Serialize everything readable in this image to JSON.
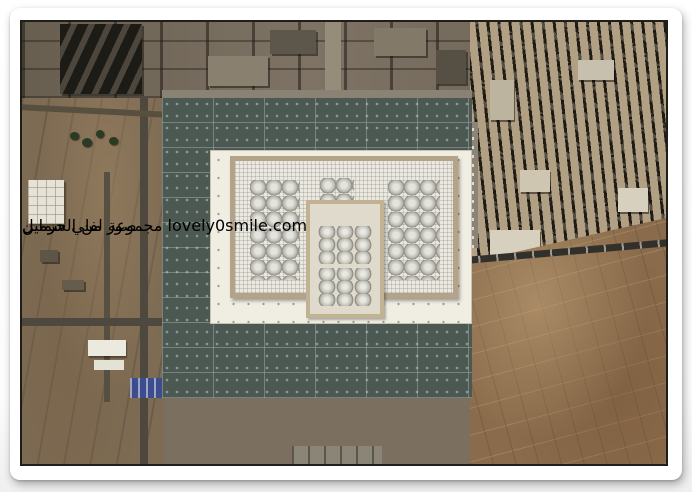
{
  "watermark": {
    "group_ar": "مجموعة لفلي سمايل",
    "domain": "lovely0smile.com"
  },
  "calligraphy": {
    "title_ar": "صور من الحرمين"
  },
  "icons": {
    "top_right": "green-corner-swoosh",
    "bottom_right": "green-swoosh-with-minaret",
    "center": "green-dome-of-mosque"
  },
  "colors": {
    "ribbon_green": "#57b42c",
    "ribbon_green_dark": "#2e8a12",
    "decor_green_light": "#8ad64f",
    "decor_green_dark": "#2e8a12",
    "plaza_gray_green": "#4c5852",
    "mosque_white": "#f0ede3",
    "mosque_wall_tan": "#b3a489",
    "terrain_brown": "#8a6b4b",
    "canopy_red": "#a0512d",
    "photo_border": "#201e18",
    "card_white": "#ffffff"
  }
}
